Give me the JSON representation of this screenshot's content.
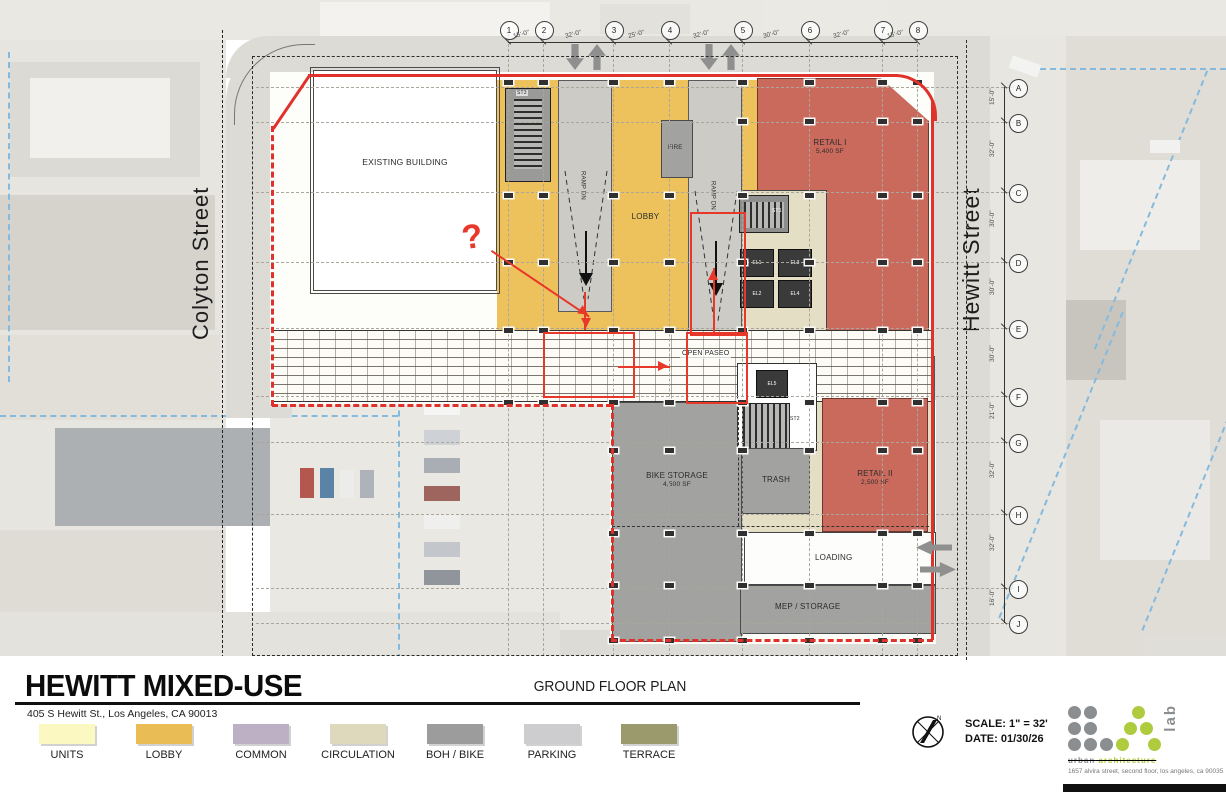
{
  "sheet": {
    "project_title": "HEWITT MIXED-USE",
    "project_address": "405 S Hewitt St., Los Angeles, CA 90013",
    "sheet_title": "GROUND FLOOR PLAN",
    "scale": "SCALE:   1\" = 32'",
    "date": "DATE:   01/30/26"
  },
  "streets": {
    "left": "Colyton Street",
    "right": "Hewitt Street"
  },
  "legend": {
    "items": [
      {
        "label": "UNITS",
        "color": "#FBF8C2"
      },
      {
        "label": "LOBBY",
        "color": "#E9BC55"
      },
      {
        "label": "COMMON",
        "color": "#BDAFC4"
      },
      {
        "label": "CIRCULATION",
        "color": "#DED8BD"
      },
      {
        "label": "BOH / BIKE",
        "color": "#9C9C9C"
      },
      {
        "label": "PARKING",
        "color": "#CDCDCF"
      },
      {
        "label": "TERRACE",
        "color": "#9A9A6C"
      }
    ]
  },
  "grid": {
    "top": {
      "bubbles": [
        "1",
        "2",
        "3",
        "4",
        "5",
        "6",
        "7",
        "8"
      ],
      "dims": [
        "15'-0\"",
        "32'-0\"",
        "25'-0\"",
        "32'-0\"",
        "30'-0\"",
        "32'-0\"",
        "15'-0\""
      ]
    },
    "right": {
      "bubbles": [
        "A",
        "B",
        "C",
        "D",
        "E",
        "F",
        "G",
        "H",
        "I",
        "J"
      ],
      "dims": [
        "15'-0\"",
        "32'-0\"",
        "30'-0\"",
        "30'-0\"",
        "30'-0\"",
        "21'-0\"",
        "32'-0\"",
        "32'-0\"",
        "16'-0\""
      ]
    }
  },
  "rooms": {
    "existing_building": "EXISTING BUILDING",
    "lobby": "LOBBY",
    "fire": "FIRE",
    "retail_1": {
      "name": "RETAIL I",
      "area": "5,400 SF"
    },
    "retail_2": {
      "name": "RETAIL II",
      "area": "2,500 SF"
    },
    "bike_storage": {
      "name": "BIKE STORAGE",
      "area": "4,500 SF"
    },
    "trash": "TRASH",
    "loading": "LOADING",
    "mep": "MEP / STORAGE",
    "open_paseo": "OPEN PASEO",
    "ramp_left": "RAMP DN",
    "ramp_right": "RAMP DN",
    "stair_st1": "ST1",
    "stair_st2": "ST2",
    "stair_st3": "ST3",
    "el1": "EL1",
    "el2": "EL2",
    "el3": "EL3",
    "el4": "EL4",
    "el5": "EL5"
  },
  "annotations": {
    "question_mark": "?"
  },
  "logo": {
    "word_gray": "urban",
    "word_green": "architecture",
    "lab": "lab",
    "address": "1657 alvira street, second floor, los angeles, ca 90035"
  }
}
